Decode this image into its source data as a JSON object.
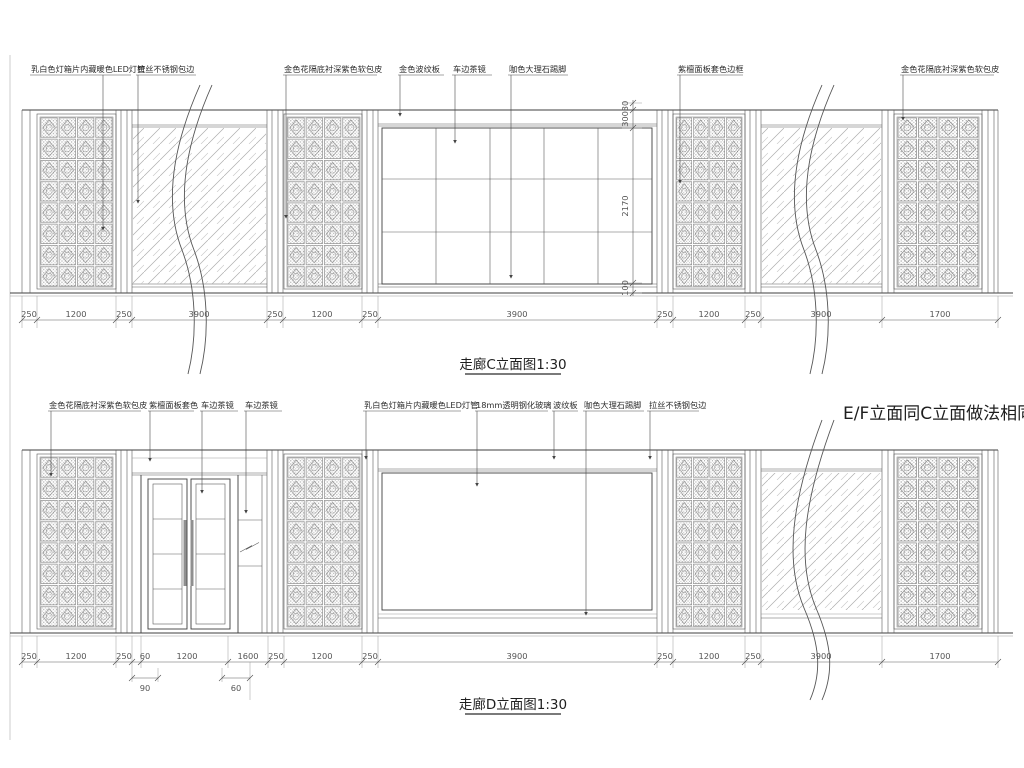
{
  "titles": {
    "c": "走廊C立面图1:30",
    "d": "走廊D立面图1:30",
    "note": "E/F立面同C立面做法相同"
  },
  "c": {
    "labels": [
      "乳白色灯箱片内藏暖色LED灯管",
      "拉丝不锈钢包边",
      "金色花隔底衬深紫色软包皮",
      "金色波纹板",
      "车边茶镜",
      "咖色大理石踢脚",
      "紫檀面板套色边框",
      "金色花隔底衬深紫色软包皮"
    ],
    "dims": [
      "250",
      "1200",
      "250",
      "3900",
      "250",
      "1200",
      "250",
      "3900",
      "250",
      "1200",
      "250",
      "3900",
      "1700"
    ],
    "vdims": [
      "30",
      "300",
      "2170",
      "100"
    ]
  },
  "d": {
    "labels": [
      "金色花隔底衬深紫色软包皮",
      "紫檀面板套色",
      "车边茶镜",
      "车边茶镜",
      "乳白色灯箱片内藏暖色LED灯管",
      "18mm透明钢化玻璃",
      "波纹板",
      "咖色大理石踢脚",
      "拉丝不锈钢包边"
    ],
    "dims": [
      "250",
      "1200",
      "250",
      "60",
      "1200",
      "1600",
      "250",
      "1200",
      "250",
      "3900",
      "250",
      "1200",
      "250",
      "3900",
      "1700"
    ],
    "dims2": [
      "90",
      "60"
    ]
  },
  "colors": {
    "background": "#ffffff",
    "line": "#3f3f3f",
    "hatch": "#b0b0b0",
    "dimension_text": "#555555"
  }
}
